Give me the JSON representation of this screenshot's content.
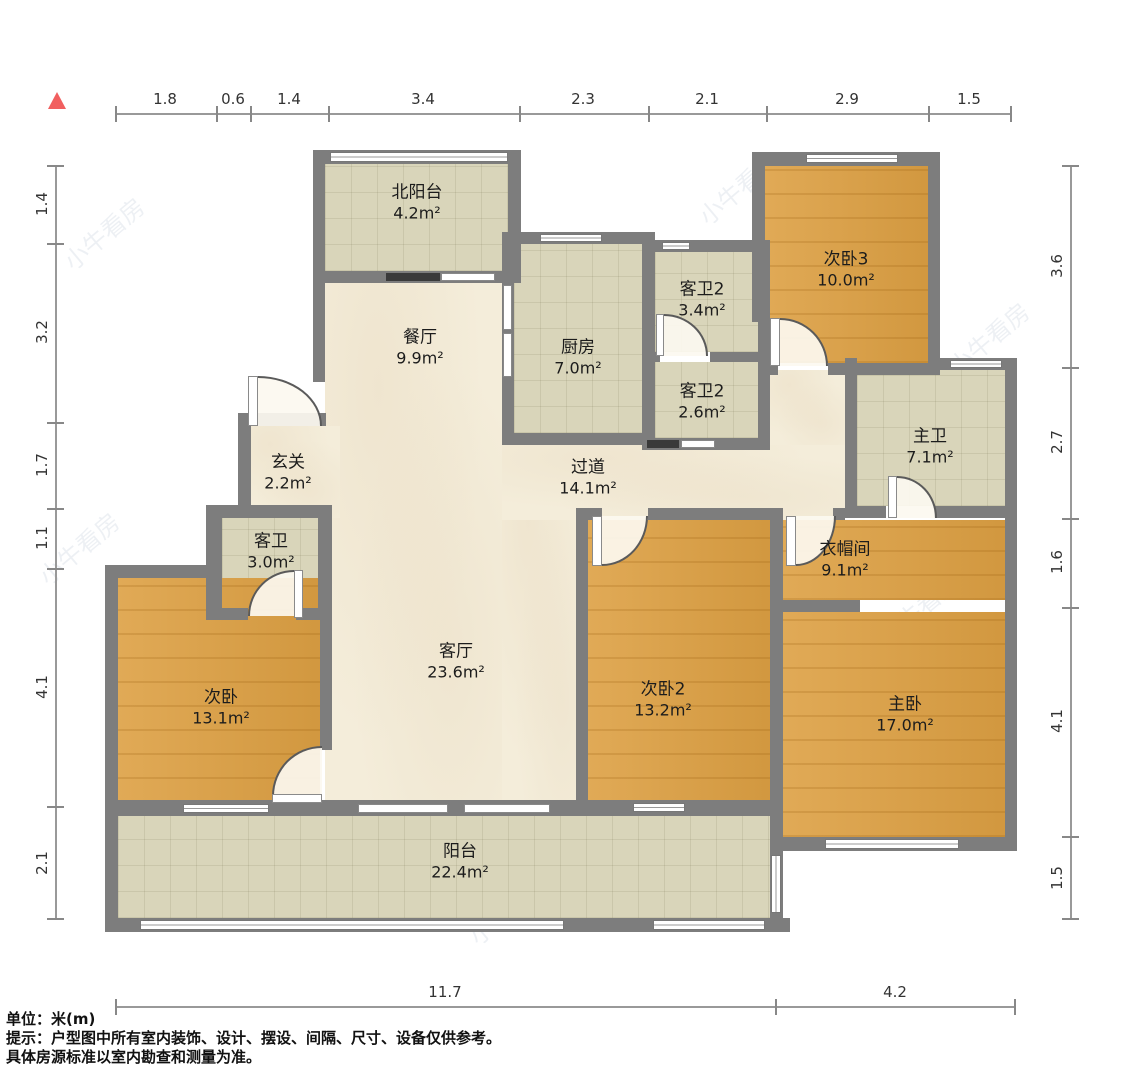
{
  "dims": {
    "top": [
      "1.8",
      "0.6",
      "1.4",
      "3.4",
      "2.3",
      "2.1",
      "2.9",
      "1.5"
    ],
    "left": [
      "1.4",
      "3.2",
      "1.7",
      "1.1",
      "4.1",
      "2.1"
    ],
    "right": [
      "3.6",
      "2.7",
      "1.6",
      "4.1",
      "1.5"
    ],
    "bottom": [
      "11.7",
      "4.2"
    ]
  },
  "rooms": {
    "north_balcony": {
      "name": "北阳台",
      "area": "4.2m²"
    },
    "dining": {
      "name": "餐厅",
      "area": "9.9m²"
    },
    "kitchen": {
      "name": "厨房",
      "area": "7.0m²"
    },
    "guest_bath2a": {
      "name": "客卫2",
      "area": "3.4m²"
    },
    "bedroom3": {
      "name": "次卧3",
      "area": "10.0m²"
    },
    "guest_bath2b": {
      "name": "客卫2",
      "area": "2.6m²"
    },
    "master_bath": {
      "name": "主卫",
      "area": "7.1m²"
    },
    "foyer": {
      "name": "玄关",
      "area": "2.2m²"
    },
    "hallway": {
      "name": "过道",
      "area": "14.1m²"
    },
    "guest_bath": {
      "name": "客卫",
      "area": "3.0m²"
    },
    "cloakroom": {
      "name": "衣帽间",
      "area": "9.1m²"
    },
    "bedroom": {
      "name": "次卧",
      "area": "13.1m²"
    },
    "living": {
      "name": "客厅",
      "area": "23.6m²"
    },
    "bedroom2": {
      "name": "次卧2",
      "area": "13.2m²"
    },
    "master_bedroom": {
      "name": "主卧",
      "area": "17.0m²"
    },
    "balcony": {
      "name": "阳台",
      "area": "22.4m²"
    }
  },
  "footer": {
    "unit_label": "单位：米(m)",
    "tip_line1": "提示：户型图中所有室内装饰、设计、摆设、间隔、尺寸、设备仅供参考。",
    "tip_line2": "具体房源标准以室内勘查和测量为准。"
  },
  "watermark": "小牛看房",
  "colors": {
    "wall": "#7d7d7d",
    "wood_floor": "#dda043",
    "tile_floor": "#d9d5ba",
    "cream_floor": "#f4edda",
    "north_arrow": "#f15f5f"
  }
}
